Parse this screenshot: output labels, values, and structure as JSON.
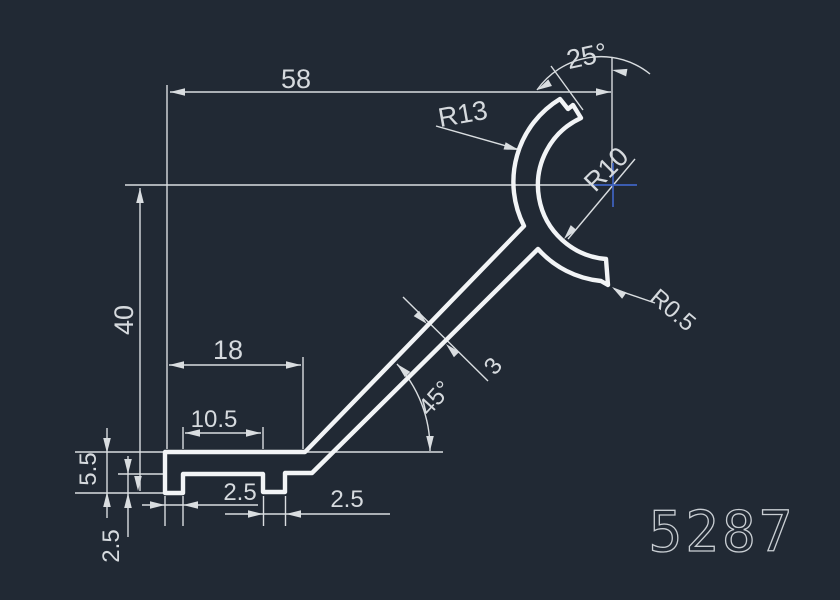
{
  "canvas": {
    "background": "#212934",
    "profile_color": "#f2f4f6",
    "dimension_color": "#d9dde0",
    "text_color": "#d6dade",
    "crosshair_color": "#3f64c2",
    "part_number_color": "#c9ced3"
  },
  "part": {
    "number": "5287"
  },
  "dims": {
    "overall_width": "58",
    "overall_height": "40",
    "opening_angle": "25°",
    "radius_outer": "R13",
    "radius_inner": "R10",
    "radius_tip": "R0.5",
    "foot_length": "18",
    "foot_slot": "10.5",
    "wall_thickness": "3",
    "arm_angle": "45°",
    "foot_height": "5.5",
    "lip_depth": "2.5",
    "lip_width_left": "2.5",
    "lip_width_mid": "2.5"
  }
}
